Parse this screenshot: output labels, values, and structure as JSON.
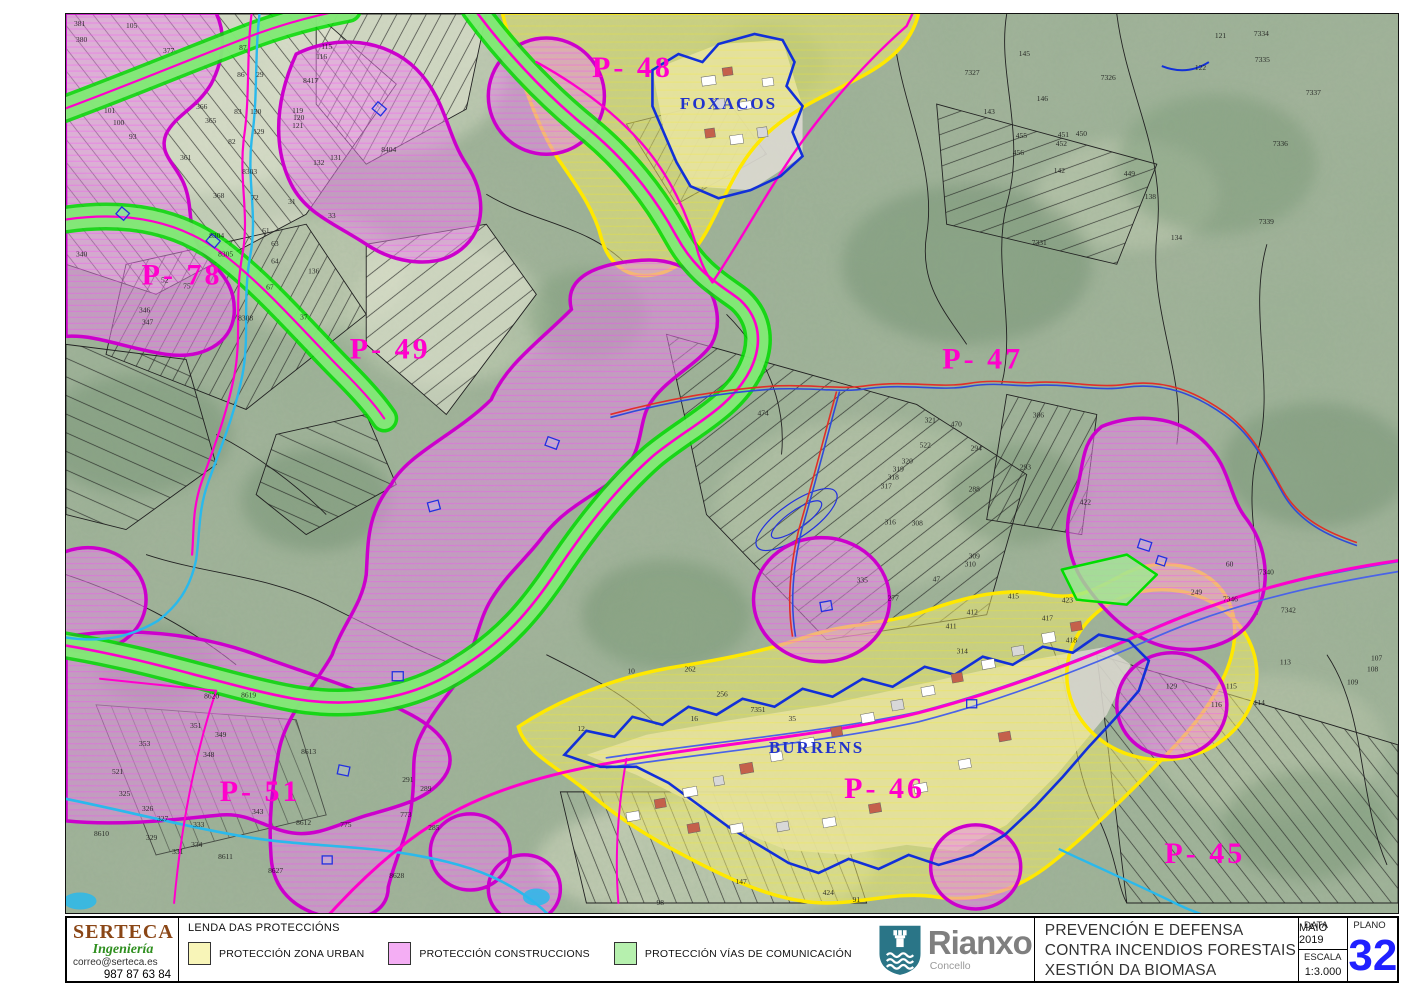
{
  "colors": {
    "zone_urban": "#f3ee6e",
    "zone_urban_border": "#ffe800",
    "zone_constructions": "#e887e8",
    "zone_constructions_border": "#cc00cc",
    "zone_vias_edge": "#00dd00",
    "zone_vias_fill": "#9deb8f",
    "road": "#ff00cc",
    "stream": "#2ab9ec",
    "boundary_blue": "#1230d8",
    "plano_number": "#2020ff",
    "legend_swatches": [
      "#f8f5b8",
      "#f4aef4",
      "#b6f0ae"
    ]
  },
  "map": {
    "region_labels": [
      {
        "text": "P- 48",
        "x": 566,
        "y": 63,
        "size": 30,
        "c": "#ff00cc",
        "cls": "rlabel"
      },
      {
        "text": "FOXACOS",
        "x": 662,
        "y": 95,
        "size": 17,
        "c": "#2233cc",
        "cls": "place"
      },
      {
        "text": "P- 78",
        "x": 116,
        "y": 270,
        "size": 30,
        "c": "#ff00cc",
        "cls": "rlabel"
      },
      {
        "text": "P- 49",
        "x": 324,
        "y": 344,
        "size": 30,
        "c": "#ff00cc",
        "cls": "rlabel"
      },
      {
        "text": "P- 47",
        "x": 916,
        "y": 354,
        "size": 30,
        "c": "#ff00cc",
        "cls": "rlabel"
      },
      {
        "text": "P- 51",
        "x": 194,
        "y": 786,
        "size": 30,
        "c": "#ff00cc",
        "cls": "rlabel"
      },
      {
        "text": "BURRENS",
        "x": 750,
        "y": 738,
        "size": 17,
        "c": "#2233cc",
        "cls": "place"
      },
      {
        "text": "P- 46",
        "x": 818,
        "y": 783,
        "size": 30,
        "c": "#ff00cc",
        "cls": "rlabel"
      },
      {
        "text": "P- 45",
        "x": 1138,
        "y": 848,
        "size": 30,
        "c": "#ff00cc",
        "cls": "rlabel"
      }
    ],
    "parcel_numbers": [
      {
        "n": "381",
        "x": 8,
        "y": 12
      },
      {
        "n": "380",
        "x": 10,
        "y": 28
      },
      {
        "n": "105",
        "x": 60,
        "y": 14
      },
      {
        "n": "377",
        "x": 97,
        "y": 39
      },
      {
        "n": "101",
        "x": 38,
        "y": 99
      },
      {
        "n": "100",
        "x": 47,
        "y": 111
      },
      {
        "n": "93",
        "x": 63,
        "y": 125
      },
      {
        "n": "87",
        "x": 173,
        "y": 36
      },
      {
        "n": "29",
        "x": 190,
        "y": 63
      },
      {
        "n": "86",
        "x": 171,
        "y": 63
      },
      {
        "n": "83",
        "x": 168,
        "y": 100
      },
      {
        "n": "130",
        "x": 184,
        "y": 100
      },
      {
        "n": "129",
        "x": 187,
        "y": 120
      },
      {
        "n": "82",
        "x": 162,
        "y": 130
      },
      {
        "n": "365",
        "x": 139,
        "y": 109
      },
      {
        "n": "366",
        "x": 130,
        "y": 95
      },
      {
        "n": "8303",
        "x": 176,
        "y": 160
      },
      {
        "n": "361",
        "x": 114,
        "y": 146
      },
      {
        "n": "368",
        "x": 147,
        "y": 184
      },
      {
        "n": "8304",
        "x": 143,
        "y": 224
      },
      {
        "n": "8305",
        "x": 152,
        "y": 242
      },
      {
        "n": "340",
        "x": 10,
        "y": 242
      },
      {
        "n": "52",
        "x": 95,
        "y": 268
      },
      {
        "n": "75",
        "x": 117,
        "y": 274
      },
      {
        "n": "346",
        "x": 73,
        "y": 298
      },
      {
        "n": "115",
        "x": 255,
        "y": 35
      },
      {
        "n": "116",
        "x": 250,
        "y": 45
      },
      {
        "n": "8417",
        "x": 237,
        "y": 69
      },
      {
        "n": "119",
        "x": 226,
        "y": 99
      },
      {
        "n": "120",
        "x": 227,
        "y": 106
      },
      {
        "n": "121",
        "x": 226,
        "y": 114
      },
      {
        "n": "131",
        "x": 264,
        "y": 146
      },
      {
        "n": "132",
        "x": 247,
        "y": 151
      },
      {
        "n": "8404",
        "x": 315,
        "y": 138
      },
      {
        "n": "136",
        "x": 242,
        "y": 259
      },
      {
        "n": "72",
        "x": 185,
        "y": 186
      },
      {
        "n": "31",
        "x": 222,
        "y": 190
      },
      {
        "n": "33",
        "x": 262,
        "y": 204
      },
      {
        "n": "61",
        "x": 196,
        "y": 219
      },
      {
        "n": "63",
        "x": 205,
        "y": 232
      },
      {
        "n": "64",
        "x": 205,
        "y": 249
      },
      {
        "n": "67",
        "x": 200,
        "y": 275
      },
      {
        "n": "37",
        "x": 234,
        "y": 305
      },
      {
        "n": "8308",
        "x": 172,
        "y": 306
      },
      {
        "n": "145",
        "x": 952,
        "y": 42
      },
      {
        "n": "7327",
        "x": 898,
        "y": 61
      },
      {
        "n": "7326",
        "x": 1034,
        "y": 66
      },
      {
        "n": "122",
        "x": 1128,
        "y": 56
      },
      {
        "n": "121",
        "x": 1148,
        "y": 24
      },
      {
        "n": "146",
        "x": 970,
        "y": 87
      },
      {
        "n": "143",
        "x": 917,
        "y": 100
      },
      {
        "n": "455",
        "x": 949,
        "y": 124
      },
      {
        "n": "456",
        "x": 946,
        "y": 141
      },
      {
        "n": "451",
        "x": 991,
        "y": 123
      },
      {
        "n": "450",
        "x": 1009,
        "y": 122
      },
      {
        "n": "452",
        "x": 989,
        "y": 132
      },
      {
        "n": "142",
        "x": 987,
        "y": 159
      },
      {
        "n": "449",
        "x": 1057,
        "y": 162
      },
      {
        "n": "138",
        "x": 1078,
        "y": 185
      },
      {
        "n": "134",
        "x": 1104,
        "y": 226
      },
      {
        "n": "7331",
        "x": 965,
        "y": 231
      },
      {
        "n": "7334",
        "x": 1187,
        "y": 22
      },
      {
        "n": "7335",
        "x": 1188,
        "y": 48
      },
      {
        "n": "7337",
        "x": 1239,
        "y": 81
      },
      {
        "n": "7336",
        "x": 1206,
        "y": 132
      },
      {
        "n": "7339",
        "x": 1192,
        "y": 210
      },
      {
        "n": "474",
        "x": 691,
        "y": 401
      },
      {
        "n": "321",
        "x": 858,
        "y": 408
      },
      {
        "n": "470",
        "x": 884,
        "y": 412
      },
      {
        "n": "522",
        "x": 853,
        "y": 433
      },
      {
        "n": "320",
        "x": 835,
        "y": 449
      },
      {
        "n": "319",
        "x": 826,
        "y": 457
      },
      {
        "n": "318",
        "x": 821,
        "y": 465
      },
      {
        "n": "317",
        "x": 814,
        "y": 474
      },
      {
        "n": "316",
        "x": 818,
        "y": 510
      },
      {
        "n": "308",
        "x": 845,
        "y": 511
      },
      {
        "n": "294",
        "x": 904,
        "y": 436
      },
      {
        "n": "293",
        "x": 953,
        "y": 455
      },
      {
        "n": "288",
        "x": 902,
        "y": 477
      },
      {
        "n": "306",
        "x": 966,
        "y": 403
      },
      {
        "n": "309",
        "x": 902,
        "y": 544
      },
      {
        "n": "310",
        "x": 898,
        "y": 552
      },
      {
        "n": "335",
        "x": 790,
        "y": 568
      },
      {
        "n": "277",
        "x": 821,
        "y": 586
      },
      {
        "n": "47",
        "x": 866,
        "y": 567
      },
      {
        "n": "415",
        "x": 941,
        "y": 584
      },
      {
        "n": "412",
        "x": 900,
        "y": 600
      },
      {
        "n": "411",
        "x": 879,
        "y": 614
      },
      {
        "n": "417",
        "x": 975,
        "y": 606
      },
      {
        "n": "314",
        "x": 890,
        "y": 639
      },
      {
        "n": "8620",
        "x": 138,
        "y": 684
      },
      {
        "n": "8619",
        "x": 175,
        "y": 683
      },
      {
        "n": "8613",
        "x": 235,
        "y": 739
      },
      {
        "n": "8610",
        "x": 28,
        "y": 821
      },
      {
        "n": "8611",
        "x": 152,
        "y": 844
      },
      {
        "n": "8612",
        "x": 230,
        "y": 810
      },
      {
        "n": "8627",
        "x": 202,
        "y": 858
      },
      {
        "n": "8628",
        "x": 323,
        "y": 863
      },
      {
        "n": "775",
        "x": 274,
        "y": 812
      },
      {
        "n": "353",
        "x": 73,
        "y": 731
      },
      {
        "n": "351",
        "x": 124,
        "y": 713
      },
      {
        "n": "349",
        "x": 149,
        "y": 722
      },
      {
        "n": "348",
        "x": 137,
        "y": 742
      },
      {
        "n": "347",
        "x": 76,
        "y": 310
      },
      {
        "n": "343",
        "x": 186,
        "y": 799
      },
      {
        "n": "333",
        "x": 127,
        "y": 812
      },
      {
        "n": "334",
        "x": 125,
        "y": 832
      },
      {
        "n": "331",
        "x": 106,
        "y": 839
      },
      {
        "n": "326",
        "x": 76,
        "y": 796
      },
      {
        "n": "325",
        "x": 53,
        "y": 781
      },
      {
        "n": "327",
        "x": 91,
        "y": 806
      },
      {
        "n": "329",
        "x": 80,
        "y": 825
      },
      {
        "n": "521",
        "x": 46,
        "y": 759
      },
      {
        "n": "291",
        "x": 336,
        "y": 767
      },
      {
        "n": "289",
        "x": 354,
        "y": 776
      },
      {
        "n": "773",
        "x": 334,
        "y": 802
      },
      {
        "n": "285",
        "x": 362,
        "y": 815
      },
      {
        "n": "7351",
        "x": 684,
        "y": 697
      },
      {
        "n": "10",
        "x": 561,
        "y": 659
      },
      {
        "n": "262",
        "x": 618,
        "y": 657
      },
      {
        "n": "256",
        "x": 650,
        "y": 682
      },
      {
        "n": "35",
        "x": 722,
        "y": 706
      },
      {
        "n": "16",
        "x": 624,
        "y": 706
      },
      {
        "n": "12",
        "x": 511,
        "y": 716
      },
      {
        "n": "98",
        "x": 590,
        "y": 890
      },
      {
        "n": "424",
        "x": 756,
        "y": 880
      },
      {
        "n": "91",
        "x": 786,
        "y": 887
      },
      {
        "n": "147",
        "x": 669,
        "y": 869
      },
      {
        "n": "422",
        "x": 1013,
        "y": 490
      },
      {
        "n": "423",
        "x": 995,
        "y": 588
      },
      {
        "n": "418",
        "x": 999,
        "y": 628
      },
      {
        "n": "249",
        "x": 1124,
        "y": 580
      },
      {
        "n": "60",
        "x": 1159,
        "y": 552
      },
      {
        "n": "7340",
        "x": 1192,
        "y": 560
      },
      {
        "n": "7346",
        "x": 1156,
        "y": 587
      },
      {
        "n": "7342",
        "x": 1214,
        "y": 598
      },
      {
        "n": "113",
        "x": 1213,
        "y": 650
      },
      {
        "n": "115",
        "x": 1159,
        "y": 674
      },
      {
        "n": "116",
        "x": 1144,
        "y": 692
      },
      {
        "n": "107",
        "x": 1304,
        "y": 646
      },
      {
        "n": "108",
        "x": 1300,
        "y": 657
      },
      {
        "n": "109",
        "x": 1280,
        "y": 670
      },
      {
        "n": "129",
        "x": 1099,
        "y": 674
      },
      {
        "n": "114",
        "x": 1187,
        "y": 690
      }
    ]
  },
  "footer": {
    "serteca": {
      "name": "SERTECA",
      "subtitle": "Ingeniería",
      "email": "correo@serteca.es",
      "phone": "987 87 63 84"
    },
    "legend": {
      "title": "LENDA DAS PROTECCIÓNS",
      "items": [
        {
          "label": "PROTECCIÓN ZONA URBAN",
          "color": "#f8f5b8"
        },
        {
          "label": "PROTECCIÓN CONSTRUCCIONS",
          "color": "#f4aef4"
        },
        {
          "label": "PROTECCIÓN VÍAS DE COMUNICACIÓN",
          "color": "#b6f0ae"
        }
      ]
    },
    "rianxo": {
      "name": "Rianxo",
      "subtitle": "Concello"
    },
    "project": {
      "line1": "PREVENCIÓN E DEFENSA",
      "line2": "CONTRA INCENDIOS FORESTAIS",
      "line3": "XESTIÓN DA BIOMASA"
    },
    "meta": {
      "data_label": "DATA",
      "data_value": "MAIO 2019",
      "escala_label": "ESCALA",
      "escala_value": "1:3.000",
      "plano_label": "PLANO",
      "plano_value": "32"
    }
  }
}
